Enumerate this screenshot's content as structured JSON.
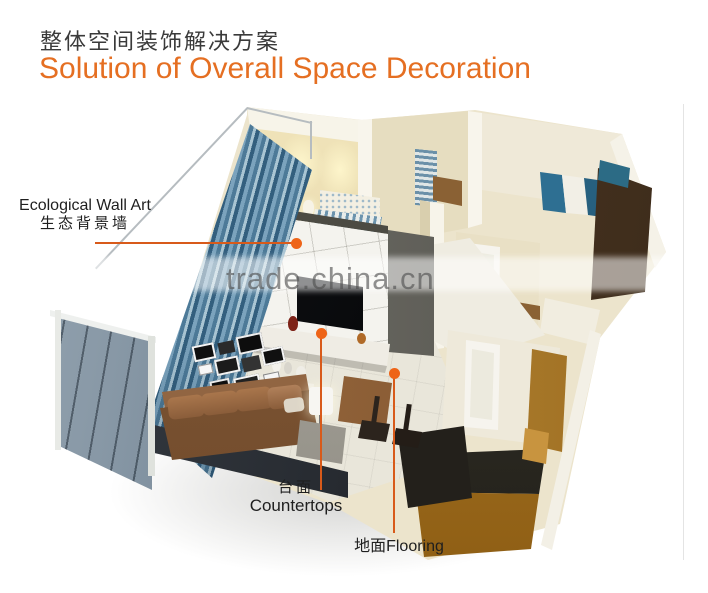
{
  "header": {
    "title_zh": "整体空间装饰解决方案",
    "title_en": "Solution of Overall Space Decoration"
  },
  "watermark": {
    "text": "trade.china.cn"
  },
  "callouts": {
    "wall_art": {
      "label_en": "Ecological Wall Art",
      "label_zh": "生态背景墙"
    },
    "countertops": {
      "label_zh": "台面",
      "label_en": "Countertops"
    },
    "flooring": {
      "label": "地面Flooring"
    }
  },
  "colors": {
    "title_zh": "#3a3a3a",
    "title_en_orange": "#e56f22",
    "callout_line": "#d85a1a",
    "callout_dot": "#ee6418",
    "watermark_gray": "#4f4f4f"
  },
  "scene": {
    "description": "3D isometric cutaway rendering of a furnished apartment (living room with sofa, gallery frames, TV feature wall and marble countertop, blue curtains and glass balcony railing, bedrooms, kitchen with wooden cabinets)"
  }
}
